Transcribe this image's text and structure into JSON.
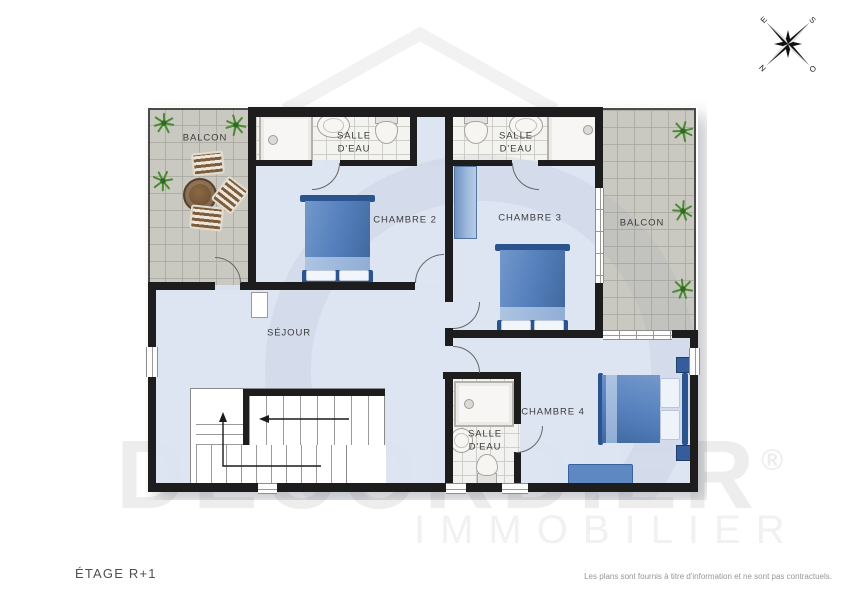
{
  "page": {
    "floor_label": "ÉTAGE R+1",
    "disclaimer": "Les plans sont fournis à titre d'information et ne sont pas contractuels."
  },
  "watermark": {
    "brand": "DECORDIER",
    "registered": "®",
    "subtitle": "IMMOBILIER"
  },
  "compass": {
    "n": "N",
    "s": "S",
    "e": "E",
    "o": "O"
  },
  "rooms": {
    "balcony_left": {
      "label": "BALCON"
    },
    "bath_top_left": {
      "label": "SALLE D'EAU"
    },
    "bedroom2": {
      "label": "CHAMBRE 2"
    },
    "bath_top_right": {
      "label": "SALLE D'EAU"
    },
    "bedroom3": {
      "label": "CHAMBRE 3"
    },
    "balcony_right": {
      "label": "BALCON"
    },
    "living": {
      "label": "SÉJOUR"
    },
    "bedroom4": {
      "label": "CHAMBRE 4"
    },
    "bath_bottom": {
      "label": "SALLE D'EAU"
    }
  },
  "colors": {
    "wall": "#1d1d1d",
    "room_floor": "#dbe3f1",
    "bath_tile": "#f3f2ef",
    "balcony_tile": "#c8c7bf",
    "bed_blue": "#5580bd",
    "bed_dark": "#2b548f",
    "plant_green": "#4c8a33",
    "table_brown": "#6b4e31",
    "label_text": "#3c3c3c"
  }
}
